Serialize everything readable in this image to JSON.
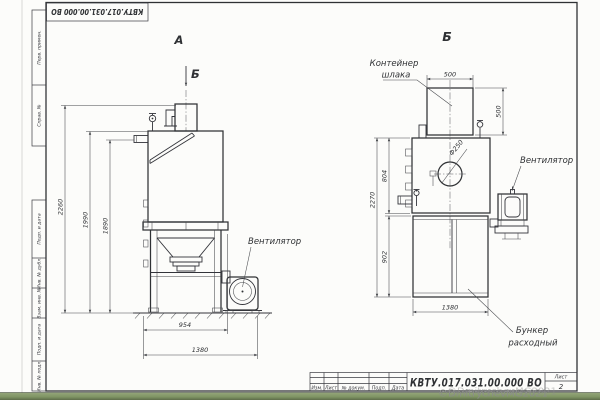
{
  "sheet": {
    "code": "КВТУ.017.031.00.000  ВО",
    "watermark": "©DmitrychevMG2021",
    "side_labels": {
      "perv": "Перв. примен.",
      "sprav": "Справ. №",
      "podp1": "Подп. и дата",
      "inv_dubl": "Инв. № дубл.",
      "vzam": "Взам. инв. №",
      "podp2": "Подп. и дата",
      "inv_podl": "Инв. № подл."
    },
    "title_block": {
      "cols": {
        "izm": "Изм.",
        "list": "Лист",
        "doc": "№ докум.",
        "podp": "Подп.",
        "data": "Дата"
      },
      "sheet_label": "Лист",
      "sheet_no": "2"
    }
  },
  "view_a": {
    "label": "А",
    "section_mark": "Б",
    "fan_label": "Вентилятор",
    "dims": {
      "overall_h": "2260",
      "body_h": "1990",
      "pipe_h": "1890",
      "base_w": "954",
      "overall_w": "1380"
    }
  },
  "view_b": {
    "label": "Б",
    "container_label_1": "Контейнер",
    "container_label_2": "шлака",
    "fan_label": "Вентилятор",
    "hopper_label_1": "Бункер",
    "hopper_label_2": "расходный",
    "dims": {
      "container_w": "500",
      "container_h": "500",
      "overall_h": "2270",
      "body_h": "804",
      "frame_h": "902",
      "frame_w": "1380",
      "hole_d": "Ф250"
    }
  }
}
